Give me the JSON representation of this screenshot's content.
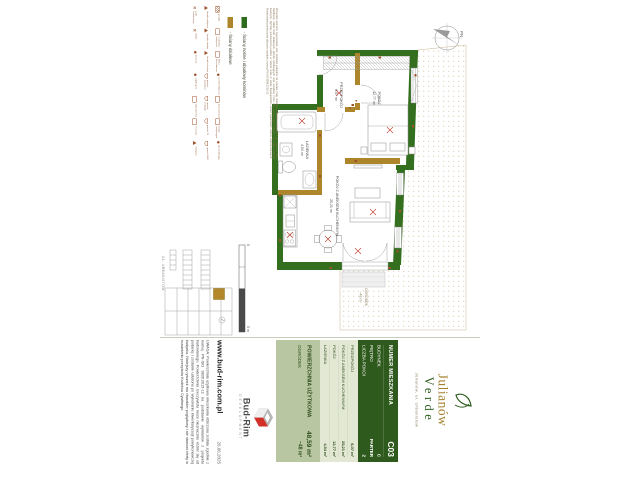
{
  "brand": {
    "line1": "Julianów",
    "line2": "Verde",
    "tagline": "Julianów, ul. Urbanistów",
    "gold": "#a5822f",
    "green": "#2d5e1e"
  },
  "unit_panel": {
    "rows": [
      {
        "label": "NUMER MIESZKANIA",
        "value": "C03"
      },
      {
        "label": "BUDYNEK",
        "value": "C"
      },
      {
        "label": "PIĘTRO",
        "value": "PARTER"
      },
      {
        "label": "LICZBA POKOI",
        "value": "2"
      }
    ]
  },
  "rooms": {
    "rows": [
      {
        "label": "PRZEDPOKÓJ",
        "value": "6,07 m²"
      },
      {
        "label": "POKÓJ Z ANEKSEM KUCHENNYM",
        "value": "25,21 m²"
      },
      {
        "label": "POKÓJ",
        "value": "12,77 m²"
      },
      {
        "label": "ŁAZIENKA",
        "value": "4,54 m²"
      }
    ]
  },
  "summary": {
    "rows": [
      {
        "label": "POWIERZCHNIA UŻYTKOWA",
        "value": "48,59 m²"
      },
      {
        "label": "OGRÓDEK",
        "value": "~48 m²"
      }
    ]
  },
  "developer": {
    "name": "Bud-Rim",
    "sub": "DEVELOPMENT",
    "website": "www.bud-rim.com.pl",
    "date": "26.06.2025",
    "disclaimer": "UWAGA: Powierzchnia użytkowa mieszkania obliczona została zgodnie z normą PN-ISO 9836:2015-12 na podstawie wymiarów z projektu budowlanego. Powierzchnia rzeczywista może nieznacznie różnić się od podanej i zostanie ustalona po wykonaniu inwentaryzacji powykonawczej budynku. Niniejszy rysunek ma charakter poglądowy i nie stanowi oferty w rozumieniu przepisów Kodeksu Cywilnego."
  },
  "legend": {
    "note": "Wszystkie elementy wyposażenia oraz aranżacji pokazane na rysunku mają charakter wyłącznie poglądowy i nie stanowią oferty handlowej. Układ ścian działowych, pionów instalacyjnych oraz urządzeń może ulec nieznacznym zmianom na etapie realizacji inwestycji. Wymiary pomieszczeń podano w świetle ścian w stanie deweloperskim, przed wykonaniem warstw wykończeniowych. Powierzchnie pomieszczeń obliczono zgodnie z normą PN-ISO 9836:2015-12.",
    "wall_types": [
      {
        "label": "- Ściany nośne i obudowy kominów",
        "color": "#2f6b1d"
      },
      {
        "label": "- Ściany działowe",
        "color": "#ad862b"
      }
    ],
    "items": [
      {
        "label": "grzejnik"
      },
      {
        "label": "rozdzielnica elektryczna"
      },
      {
        "label": "tablica teletechniczna"
      },
      {
        "label": "puszka elektryczna"
      },
      {
        "label": "drzwi wejściowe"
      },
      {
        "label": "kratka wentylacyjna"
      },
      {
        "label": "pion instalacyjny"
      },
      {
        "label": "łącznik pojedynczy"
      },
      {
        "label": "łącznik podwójny"
      },
      {
        "label": "łącznik schodowy"
      },
      {
        "label": "gniazdo pojedyncze"
      },
      {
        "label": "gniazdo podwójne"
      },
      {
        "label": "gniazdo TV"
      },
      {
        "label": "gniazdo RJ45"
      },
      {
        "label": "punkt oświetleniowy"
      },
      {
        "label": "kinkiet"
      },
      {
        "label": "dzwonek"
      },
      {
        "label": "czujnik dymu"
      },
      {
        "label": "wideodomofon"
      },
      {
        "label": "termostat"
      },
      {
        "label": "wentylator"
      }
    ]
  },
  "plan": {
    "compass": "PN",
    "garden": {
      "label": "OGRÓDEK",
      "area": "~48 m²"
    },
    "scale": {
      "start": "0",
      "end": "5 m"
    },
    "site_street": "UL. URBANISTÓW",
    "wall_color": "#336f1e",
    "partition_color": "#ad862b"
  }
}
